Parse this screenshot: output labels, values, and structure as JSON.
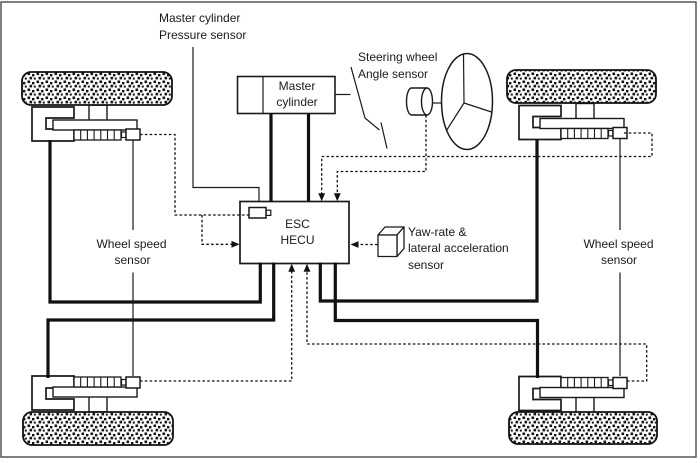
{
  "labels": {
    "mc_pressure_sensor": {
      "line1": "Master cylinder",
      "line2": "Pressure sensor"
    },
    "steering_angle_sensor": {
      "line1": "Steering wheel",
      "line2": "Angle sensor"
    },
    "master_cylinder_box": {
      "line1": "Master",
      "line2": "cylinder"
    },
    "esc_hecu_box": {
      "line1": "ESC",
      "line2": "HECU"
    },
    "yaw_sensor": {
      "line1": "Yaw-rate &",
      "line2": "lateral acceleration",
      "line3": "sensor"
    },
    "wheel_speed_sensor_left": {
      "line1": "Wheel speed",
      "line2": "sensor"
    },
    "wheel_speed_sensor_right": {
      "line1": "Wheel speed",
      "line2": "sensor"
    }
  },
  "icons": {
    "steering_wheel": "ellipse-with-three-spokes",
    "angle_sensor": "cylinder",
    "yaw_sensor": "3d-cube",
    "pressure_sensor": "small-box-with-nub",
    "wheel_speed_sensor": "small-box-with-nub",
    "tire": "stippled-rounded-rectangle"
  },
  "colors": {
    "line": "#1a1a1a",
    "background": "#ffffff",
    "frame": "#4a4a4a"
  },
  "line_styles": {
    "hydraulic": "thick-solid",
    "signal": "dashed-with-arrow",
    "label_lead": "thin-solid"
  }
}
